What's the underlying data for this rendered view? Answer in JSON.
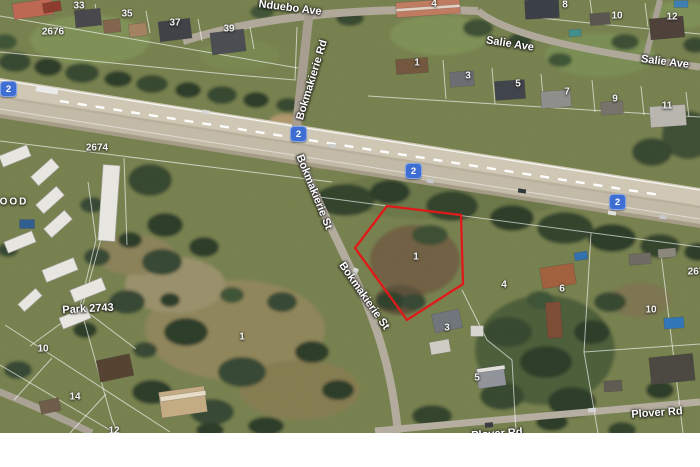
{
  "map": {
    "suburb_partial": "OOD",
    "park_label": "Park 2743",
    "route_shield": {
      "number": "2",
      "color": "#3e6ed2"
    },
    "roads": {
      "nduebo_ave": "Nduebo Ave",
      "salie_ave": "Salie Ave",
      "bokmakierie_rd": "Bokmakierie Rd",
      "bokmakierie_st": "Bokmakierie St",
      "plover_rd": "Plover Rd"
    },
    "highlight": {
      "outline_color": "#e11515",
      "parcel_number": "1"
    },
    "parcel_numbers": [
      "33",
      "35",
      "37",
      "39",
      "2676",
      "2674",
      "4",
      "8",
      "10",
      "12",
      "1",
      "3",
      "5",
      "7",
      "9",
      "11",
      "1",
      "4",
      "6",
      "3",
      "1",
      "5",
      "10",
      "14",
      "12",
      "267",
      "10"
    ]
  }
}
